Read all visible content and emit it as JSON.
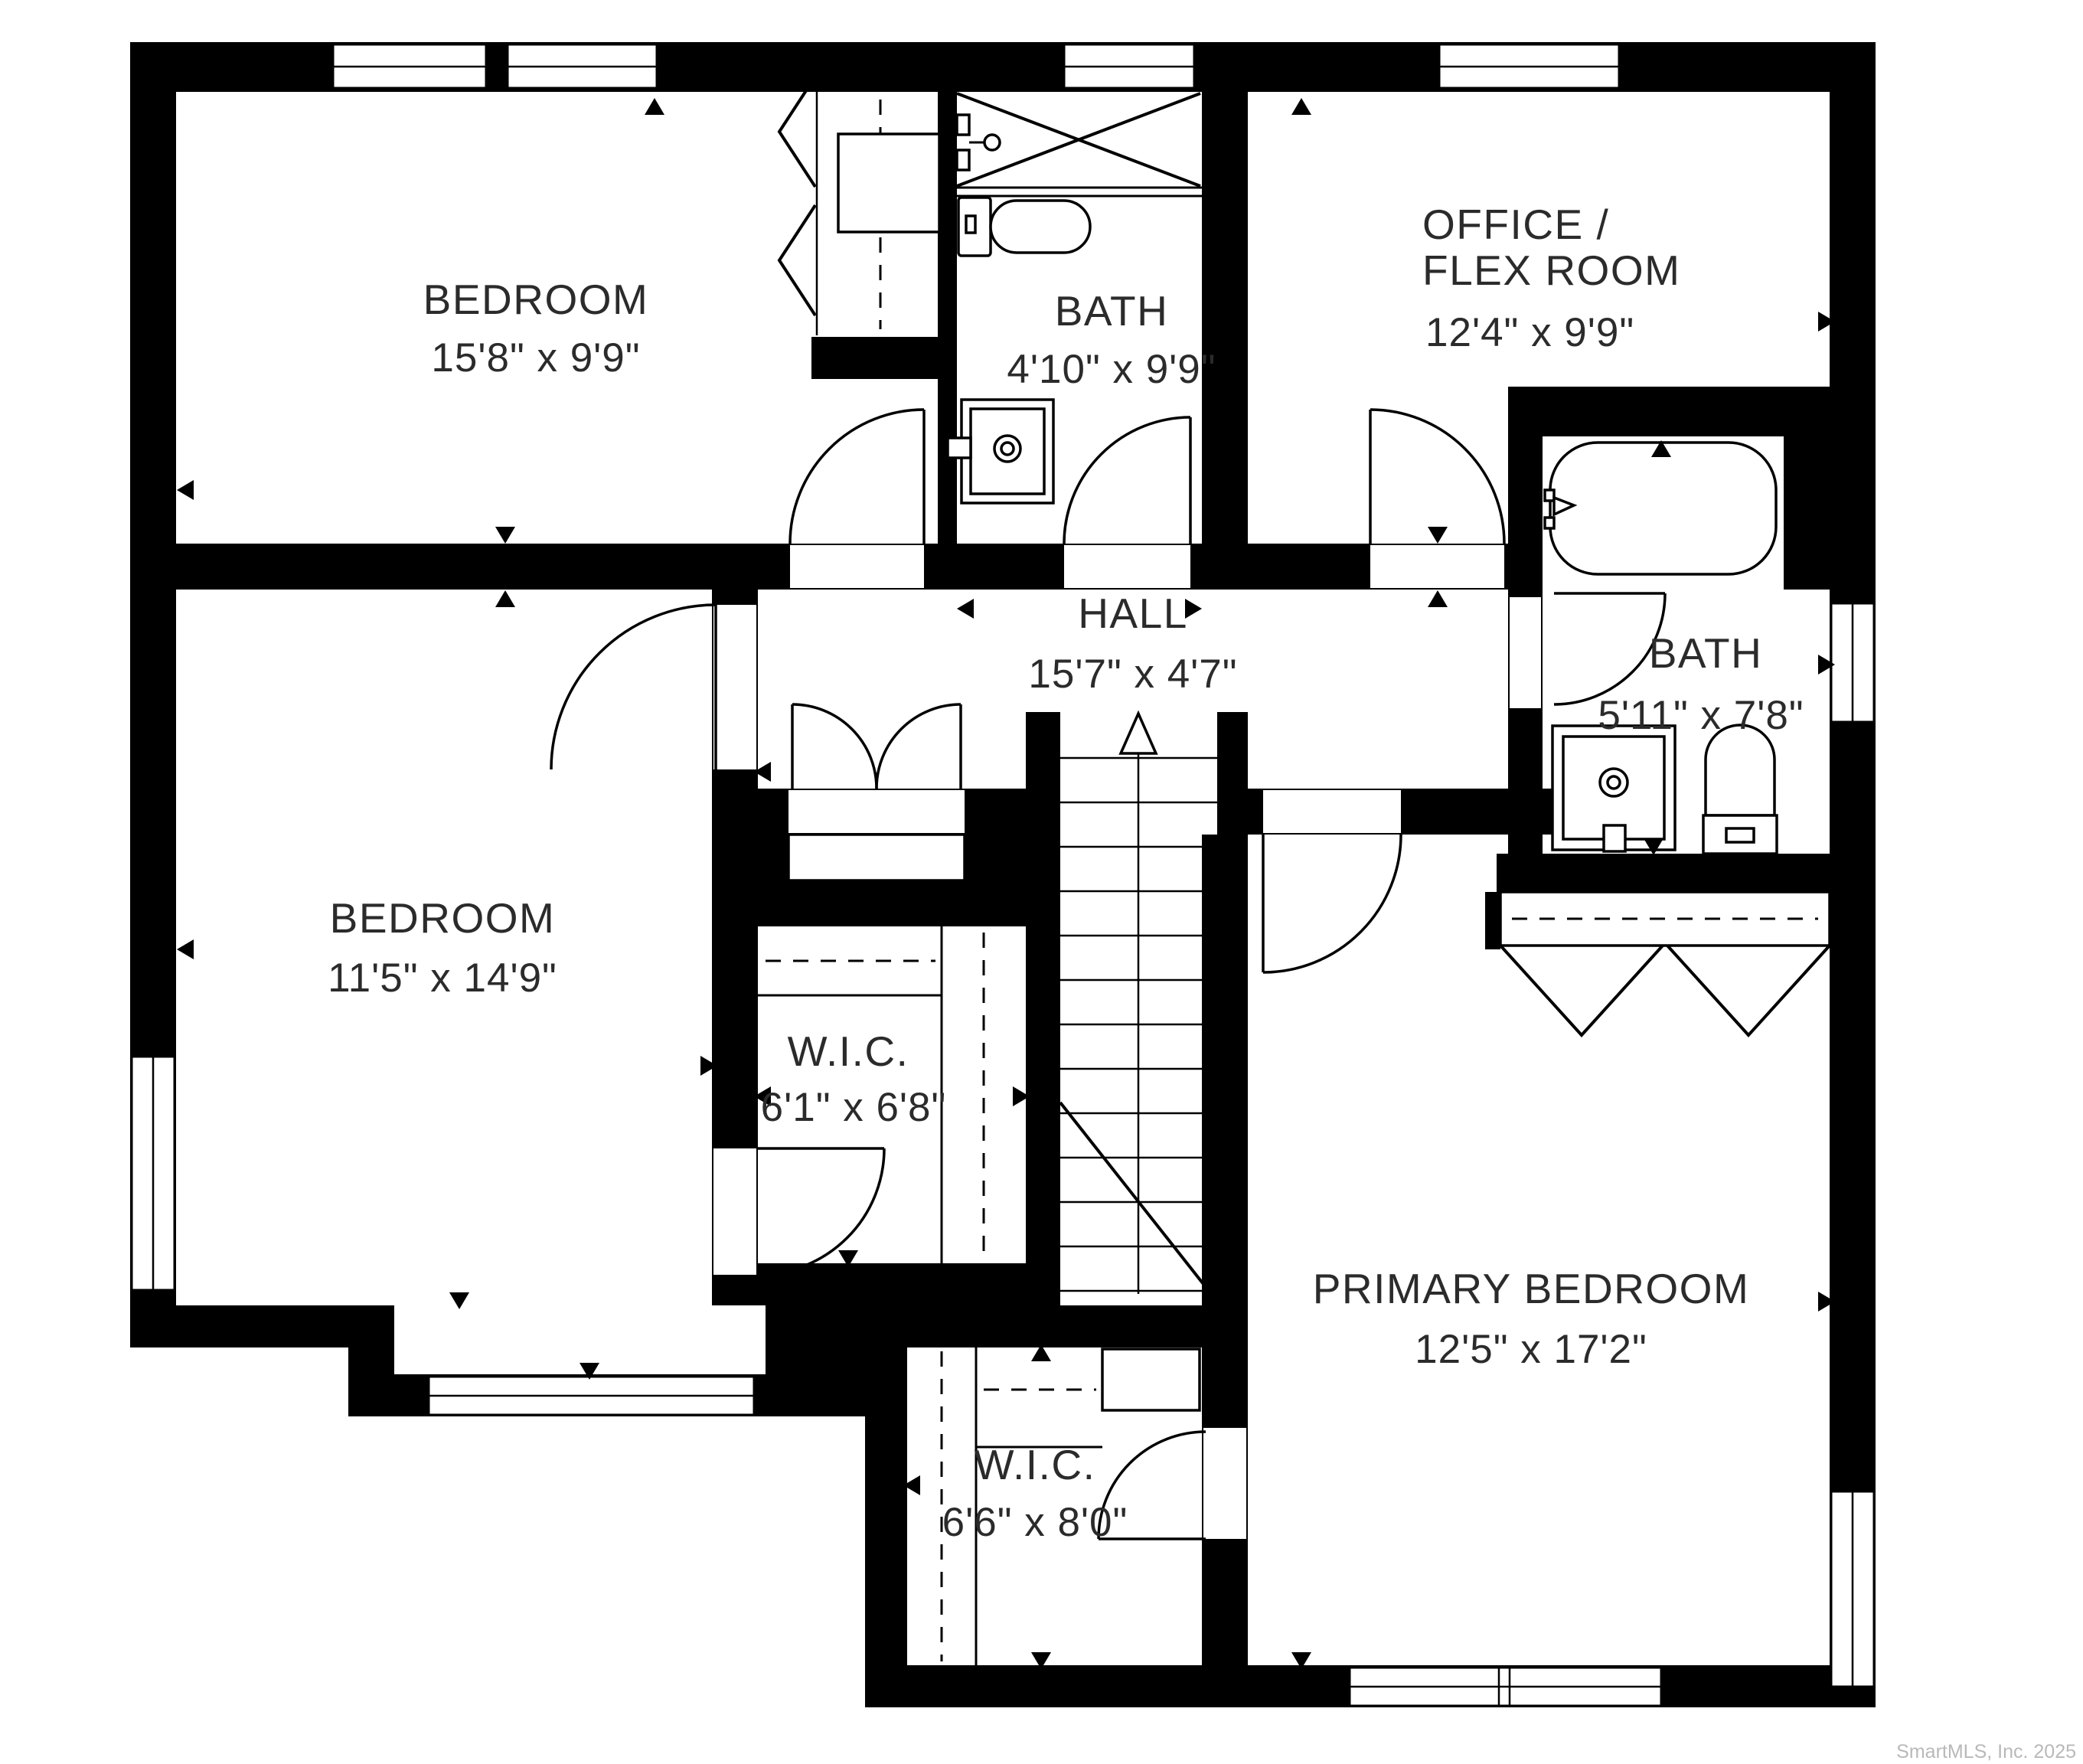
{
  "plan": {
    "rooms": [
      {
        "id": "bedroom-top",
        "name": "BEDROOM",
        "dims": "15'8\" x 9'9\""
      },
      {
        "id": "bath-top",
        "name": "BATH",
        "dims": "4'10\" x 9'9\""
      },
      {
        "id": "office-flex",
        "name": "OFFICE /",
        "name2": "FLEX ROOM",
        "dims": "12'4\" x 9'9\""
      },
      {
        "id": "hall",
        "name": "HALL",
        "dims": "15'7\" x 4'7\""
      },
      {
        "id": "bath-right",
        "name": "BATH",
        "dims": "5'11\" x 7'8\""
      },
      {
        "id": "bedroom-left",
        "name": "BEDROOM",
        "dims": "11'5\" x 14'9\""
      },
      {
        "id": "wic-middle",
        "name": "W.I.C.",
        "dims": "6'1\" x 6'8\""
      },
      {
        "id": "wic-lower",
        "name": "W.I.C.",
        "dims": "6'6\" x 8'0\""
      },
      {
        "id": "primary-bedroom",
        "name": "PRIMARY BEDROOM",
        "dims": "12'5\" x 17'2\""
      }
    ],
    "fixtures": [
      "shower",
      "toilet",
      "sink-vanity",
      "bathtub",
      "staircase-up",
      "closet-rod",
      "bifold-closet-doors",
      "double-closet-doors"
    ],
    "watermark": "SmartMLS, Inc. 2025",
    "colors": {
      "walls": "#000000",
      "floor": "#ffffff",
      "label_text": "#2b2b2b",
      "watermark_text": "#b9b9b9"
    }
  }
}
